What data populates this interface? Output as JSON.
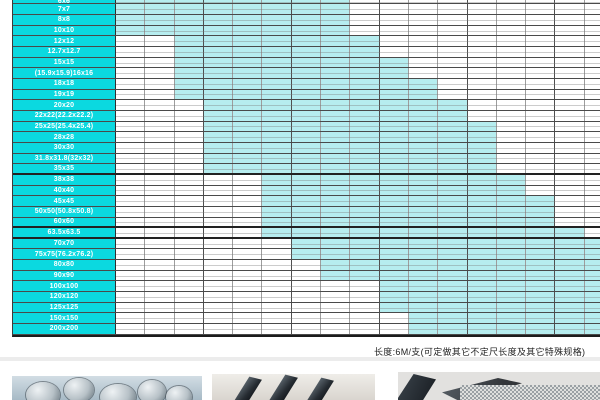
{
  "note": {
    "text": "长度:6M/支(可定做其它不定尺长度及其它特殊规格)"
  },
  "colors": {
    "label_column": "#0bd9e0",
    "available_cell": "#b6edef",
    "grid_line": "#9d9d9d",
    "group_line": "#4f4f4f"
  },
  "table": {
    "column_count": 17,
    "rows": [
      {
        "label": "6x6",
        "available_from": 1,
        "available_to": 8
      },
      {
        "label": "7x7",
        "available_from": 1,
        "available_to": 8
      },
      {
        "label": "8x8",
        "available_from": 1,
        "available_to": 8
      },
      {
        "label": "10x10",
        "available_from": 1,
        "available_to": 8
      },
      {
        "label": "12x12",
        "available_from": 3,
        "available_to": 9
      },
      {
        "label": "12.7x12.7",
        "available_from": 3,
        "available_to": 9
      },
      {
        "label": "15x15",
        "available_from": 3,
        "available_to": 10
      },
      {
        "label": "(15.9x15.9)16x16",
        "available_from": 3,
        "available_to": 10
      },
      {
        "label": "18x18",
        "available_from": 3,
        "available_to": 11
      },
      {
        "label": "19x19",
        "available_from": 3,
        "available_to": 11
      },
      {
        "label": "20x20",
        "available_from": 4,
        "available_to": 12
      },
      {
        "label": "22x22(22.2x22.2)",
        "available_from": 4,
        "available_to": 12
      },
      {
        "label": "25x25(25.4x25.4)",
        "available_from": 4,
        "available_to": 13
      },
      {
        "label": "28x28",
        "available_from": 4,
        "available_to": 13
      },
      {
        "label": "30x30",
        "available_from": 4,
        "available_to": 13
      },
      {
        "label": "31.8x31.8(32x32)",
        "available_from": 4,
        "available_to": 13
      },
      {
        "label": "35x35",
        "available_from": 4,
        "available_to": 13
      },
      {
        "label": "38x38",
        "available_from": 6,
        "available_to": 14
      },
      {
        "label": "40x40",
        "available_from": 6,
        "available_to": 14
      },
      {
        "label": "45x45",
        "available_from": 6,
        "available_to": 15
      },
      {
        "label": "50x50(50.8x50.8)",
        "available_from": 6,
        "available_to": 15
      },
      {
        "label": "60x60",
        "available_from": 6,
        "available_to": 15
      },
      {
        "label": "63.5x63.5",
        "available_from": 6,
        "available_to": 16
      },
      {
        "label": "70x70",
        "available_from": 7,
        "available_to": 17
      },
      {
        "label": "75x75(76.2x76.2)",
        "available_from": 7,
        "available_to": 17
      },
      {
        "label": "80x80",
        "available_from": 8,
        "available_to": 17
      },
      {
        "label": "90x90",
        "available_from": 8,
        "available_to": 17
      },
      {
        "label": "100x100",
        "available_from": 10,
        "available_to": 17
      },
      {
        "label": "120x120",
        "available_from": 10,
        "available_to": 17
      },
      {
        "label": "125x125",
        "available_from": 10,
        "available_to": 17
      },
      {
        "label": "150x150",
        "available_from": 11,
        "available_to": 17
      },
      {
        "label": "200x200",
        "available_from": 11,
        "available_to": 17
      }
    ]
  },
  "photos": [
    {
      "name": "round-steel-bars-photo"
    },
    {
      "name": "square-steel-bars-photo"
    },
    {
      "name": "angle-steel-profiles-photo"
    }
  ]
}
